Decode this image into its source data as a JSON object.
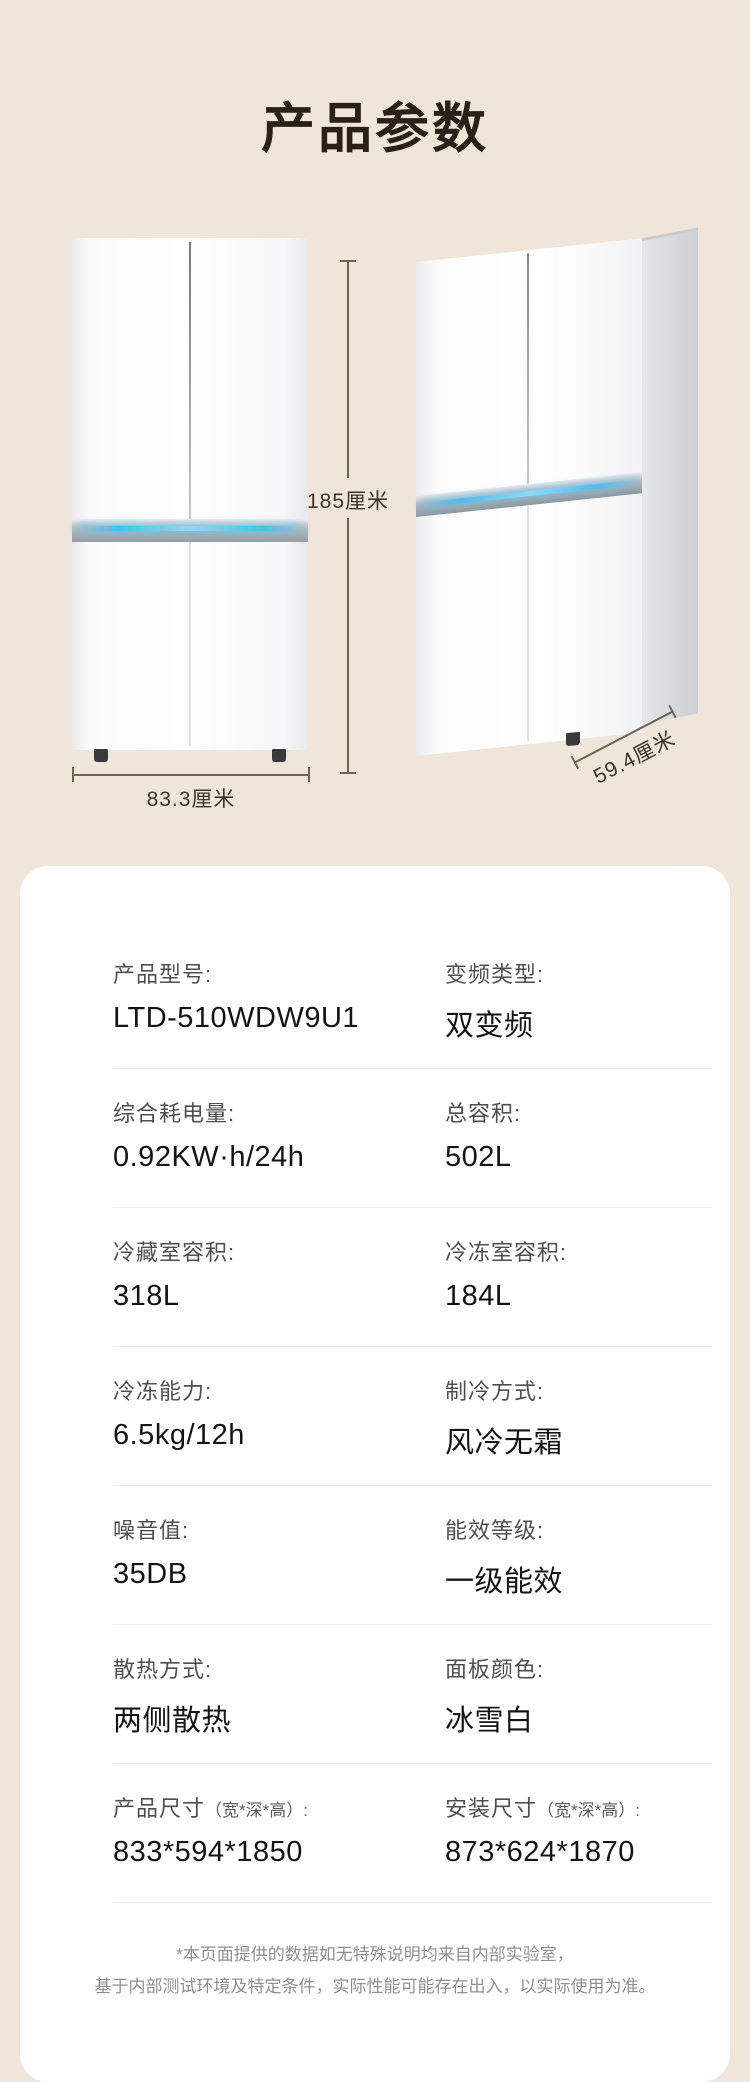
{
  "page": {
    "title": "产品参数"
  },
  "colors": {
    "background": "#EFE6D9",
    "card": "#FFFFFF",
    "accent_blue": "#50BCEC",
    "title_text": "#2A2017",
    "dimension_line": "#6F6354"
  },
  "dimensions": {
    "height_label": "185厘米",
    "width_label": "83.3厘米",
    "depth_label": "59.4厘米"
  },
  "card": {
    "rows": [
      {
        "left": {
          "label": "产品型号:",
          "sub": "",
          "value": "LTD-510WDW9U1"
        },
        "right": {
          "label": "变频类型:",
          "sub": "",
          "value": "双变频"
        }
      },
      {
        "left": {
          "label": "综合耗电量:",
          "sub": "",
          "value": "0.92KW·h/24h"
        },
        "right": {
          "label": "总容积:",
          "sub": "",
          "value": "502L"
        }
      },
      {
        "left": {
          "label": "冷藏室容积:",
          "sub": "",
          "value": "318L"
        },
        "right": {
          "label": "冷冻室容积:",
          "sub": "",
          "value": "184L"
        }
      },
      {
        "left": {
          "label": "冷冻能力:",
          "sub": "",
          "value": "6.5kg/12h"
        },
        "right": {
          "label": "制冷方式:",
          "sub": "",
          "value": "风冷无霜"
        }
      },
      {
        "left": {
          "label": "噪音值:",
          "sub": "",
          "value": "35DB"
        },
        "right": {
          "label": "能效等级:",
          "sub": "",
          "value": "一级能效"
        }
      },
      {
        "left": {
          "label": "散热方式:",
          "sub": "",
          "value": "两侧散热"
        },
        "right": {
          "label": "面板颜色:",
          "sub": "",
          "value": "冰雪白"
        }
      },
      {
        "left": {
          "label": "产品尺寸",
          "sub": "（宽*深*高）:",
          "value": "833*594*1850"
        },
        "right": {
          "label": "安装尺寸",
          "sub": "（宽*深*高）:",
          "value": "873*624*1870"
        }
      }
    ],
    "footer": {
      "line1": "*本页面提供的数据如无特殊说明均来自内部实验室，",
      "line2": "基于内部测试环境及特定条件，实际性能可能存在出入，以实际使用为准。"
    }
  }
}
